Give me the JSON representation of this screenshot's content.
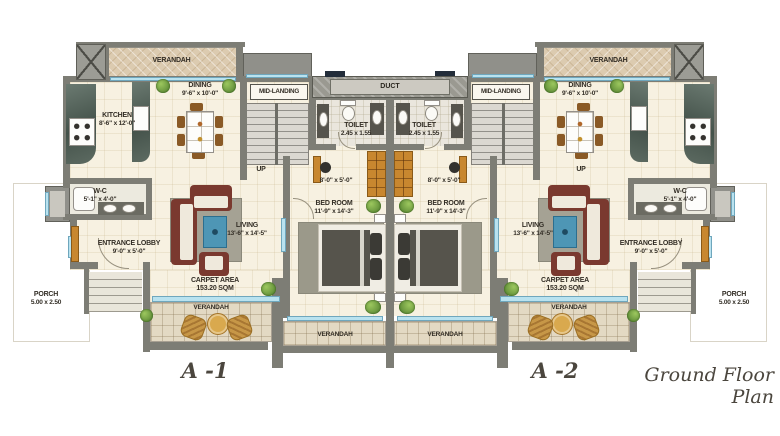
{
  "title": "Ground Floor Plan",
  "duct_label": "DUCT",
  "colors": {
    "wall_gray": "#7d7d75",
    "floor_cream": "#f7f1e1",
    "window_sill_blue": "#b9e2ef",
    "verandah_tan": "#dccbb0",
    "wood_orange": "#c8872f",
    "sofa_maroon": "#7a392f",
    "table_blue": "#4e96b5"
  },
  "units": [
    {
      "name": "A -1",
      "verandah_top": "VERANDAH",
      "kitchen_name": "KITCHEN",
      "kitchen_dims": "8'-6\" x 12'-0\"",
      "dining_name": "DINING",
      "dining_dims": "9'-6\" x 10'-0\"",
      "mid_landing": "MID-LANDING",
      "up": "UP",
      "toilet_name": "TOILET",
      "toilet_dims": "2.45 x 1.55",
      "passage_dims": "8'-0\" x 5'-0\"",
      "bedroom_name": "BED ROOM",
      "bedroom_dims": "11'-9\" x 14'-3\"",
      "living_name": "LIVING",
      "living_dims": "13'-6\" x 14'-5\"",
      "lobby_name": "ENTRANCE LOBBY",
      "lobby_dims": "9'-0\" x 5'-0\"",
      "wc_name": "W-C",
      "wc_dims": "5'-1\" x 4'-0\"",
      "carpet_line1": "CARPET AREA",
      "carpet_line2": "153.20 SQM",
      "verandah_living": "VERANDAH",
      "verandah_bedroom": "VERANDAH",
      "porch_name": "PORCH",
      "porch_dims": "5.00 x 2.50"
    },
    {
      "name": "A -2",
      "verandah_top": "VERANDAH",
      "dining_name": "DINING",
      "dining_dims": "9'-6\" x 10'-0\"",
      "mid_landing": "MID-LANDING",
      "up": "UP",
      "toilet_name": "TOILET",
      "toilet_dims": "2.45 x 1.55",
      "passage_dims": "8'-0\" x 5'-0\"",
      "bedroom_name": "BED ROOM",
      "bedroom_dims": "11'-9\" x 14'-3\"",
      "living_name": "LIVING",
      "living_dims": "13'-6\" x 14'-5\"",
      "lobby_name": "ENTRANCE LOBBY",
      "lobby_dims": "9'-0\" x 5'-0\"",
      "wc_name": "W-C",
      "wc_dims": "5'-1\" x 4'-0\"",
      "carpet_line1": "CARPET AREA",
      "carpet_line2": "153.20 SQM",
      "verandah_living": "VERANDAH",
      "verandah_bedroom": "VERANDAH",
      "porch_name": "PORCH",
      "porch_dims": "5.00 x 2.50"
    }
  ]
}
